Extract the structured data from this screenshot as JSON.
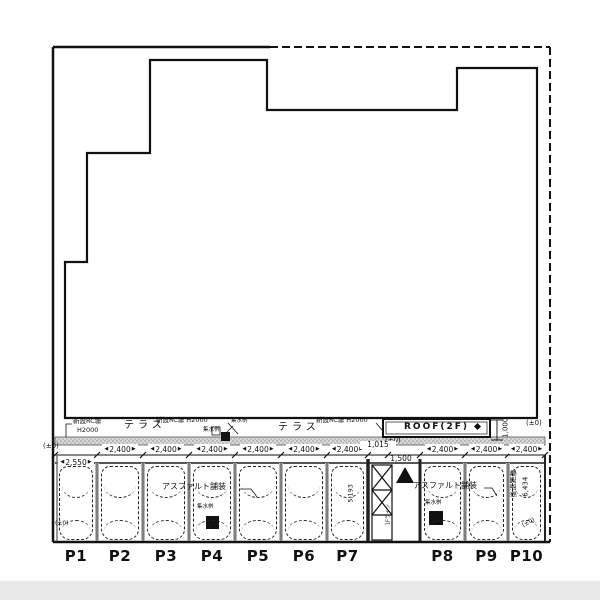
{
  "colors": {
    "line": "#111111",
    "fence_band_fill": "#d9d9d9",
    "divider_gray": "#b8b8b8",
    "bottom_bar": "#e8e8e8"
  },
  "terrace": {
    "fence_left_line1": "新設RC塀",
    "fence_left_line2": "H2000",
    "terrace_label_1": "テラス",
    "fence_mid": "新設RC塀 H2000",
    "drain_small_1": "集水桝",
    "drain_small_2": "集水桝",
    "terrace_label_2": "テラス",
    "fence_right": "新設RC塀 H2000",
    "roof_label": "ROOF(2F)",
    "roof_depth_dim": "1,000",
    "level_below_roof": "(±0)",
    "level_right_edge": "(±0)"
  },
  "parking": {
    "level_top_left": "(±0)",
    "gap_width_dim": "1,015",
    "entrance_width_dim": "1,500",
    "floor_line_label": "1Fライン",
    "depth_dim": "5,193",
    "asphalt_label_1": "アスファルト舗装",
    "asphalt_label_2": "アスファルト舗装",
    "drain_label_p4": "集水桝",
    "drain_label_p8": "集水桝",
    "setback_label": "後退距離",
    "setback_dim": "6,434",
    "level_bottom_left": "(±0)",
    "level_bottom_right": "(±0)",
    "stalls": [
      {
        "id": "P1",
        "width": "2,550"
      },
      {
        "id": "P2",
        "width": "2,400"
      },
      {
        "id": "P3",
        "width": "2,400"
      },
      {
        "id": "P4",
        "width": "2,400"
      },
      {
        "id": "P5",
        "width": "2,400"
      },
      {
        "id": "P6",
        "width": "2,400"
      },
      {
        "id": "P7",
        "width": "2,400"
      },
      {
        "id": "P8",
        "width": "2,400"
      },
      {
        "id": "P9",
        "width": "2,400"
      },
      {
        "id": "P10",
        "width": "2,400"
      }
    ]
  }
}
